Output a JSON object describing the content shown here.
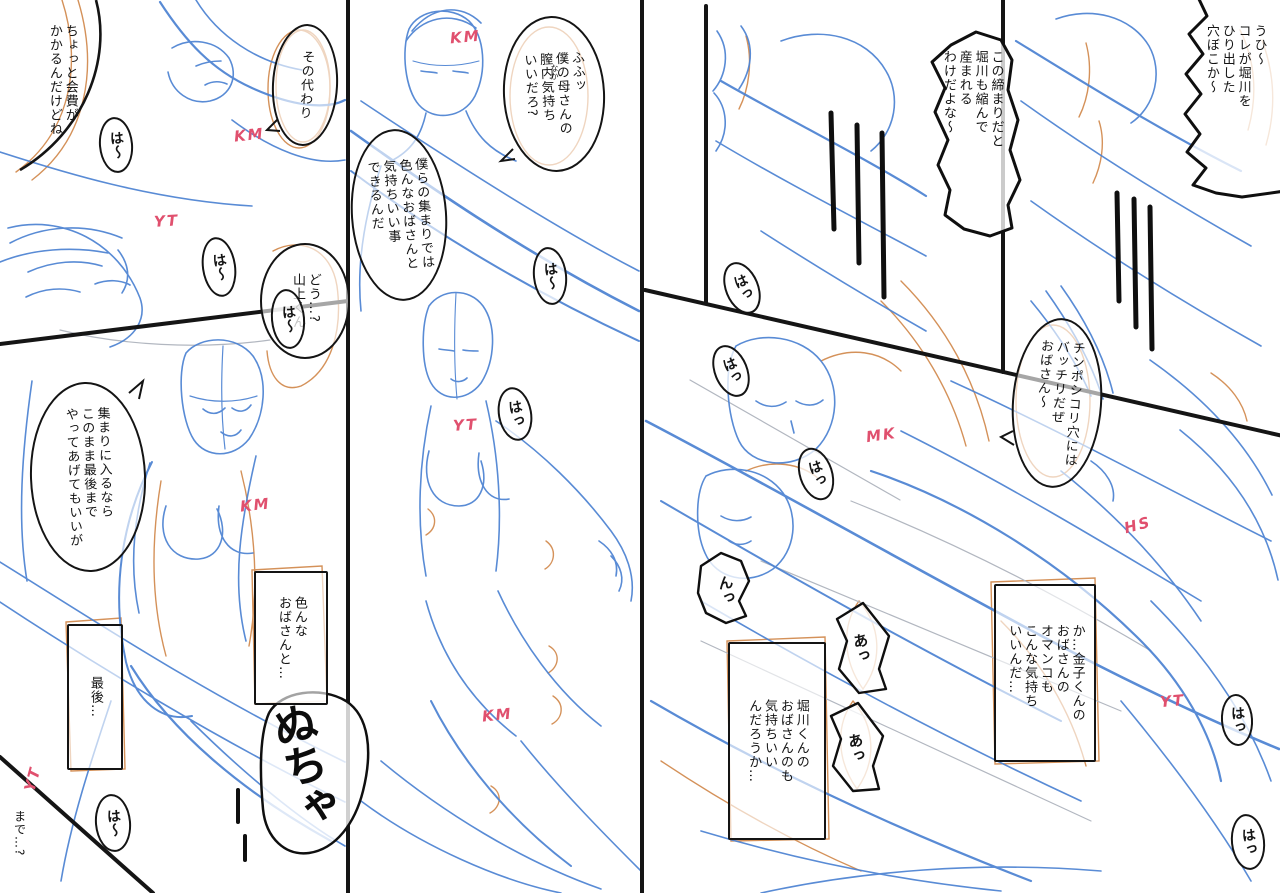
{
  "meta": {
    "kind": "manga rough storyboard spread",
    "pages": 2
  },
  "colors": {
    "paper": "#ffffff",
    "sketch_blue": "#4b82d2",
    "sketch_blue_light": "#8fb1e4",
    "sketch_orange": "#d08648",
    "pencil_gray": "#b2b7c0",
    "ink_black": "#141414",
    "initials_pink": "#e0506e"
  },
  "left": {
    "bubbles": {
      "kaihi": {
        "text": "ちょっと会費が\nかかるんだけどね"
      },
      "sonokawari": {
        "text": "その代わり"
      },
      "dou": {
        "text": "どう…?\n山上くん"
      },
      "atsumari": {
        "text": "集まりに入るなら\nこのまま最後まで\nやってあげてもいいが"
      },
      "ironna": {
        "text": "色んな\nおばさんと…"
      },
      "saigo": {
        "text": "最後…"
      },
      "made": {
        "text": "まで…?"
      },
      "fufu": {
        "text": "ふふッ\n僕の母さんの\n膣内気持ち\nいいだろ?",
        "furigana": "なか"
      },
      "bokura": {
        "text": "僕らの集まりでは\n色んなおばさんと\n気持ちいい事\nできるんだ"
      }
    },
    "sfx": {
      "ha1": "は〜",
      "ha2": "は〜",
      "ha3": "は〜",
      "ha4": "は〜",
      "ha5": "はっ",
      "ha6": "は〜",
      "nucha": "ぬちゃ"
    },
    "initials": {
      "km_a": "KM",
      "km_b": "KM",
      "km_c": "KM",
      "km_d": "KM",
      "yt_a": "YT",
      "yt_b": "YT",
      "yt_c": "YT"
    }
  },
  "right": {
    "bubbles": {
      "uhi": {
        "text": "うひ〜\nコレが堀川を\nひり出した\n穴ぼこか〜"
      },
      "shimari": {
        "text": "この締まりだと\n堀川も縮んで\n産まれる\nわけだよな〜"
      },
      "chinpo": {
        "text": "チンポシコリ穴には\nバッチリだぜ\nおばさん〜"
      },
      "kaneko": {
        "text": "か…金子くんの\nおばさんの\nオマンコも\nこんな気持ち\nいいんだ…"
      },
      "horikawa": {
        "text": "堀川くんの\nおばさんのも\n気持ちいい\nんだろうか…"
      }
    },
    "sfx": {
      "ha1": "はっ",
      "ha2": "はっ",
      "ha3": "はっ",
      "n1": "んっ",
      "a1": "あっ",
      "a2": "あっ",
      "ha4": "はっ",
      "ha5": "はっ"
    },
    "initials": {
      "mk_a": "MK",
      "hs_a": "HS",
      "yt_d": "YT"
    }
  }
}
